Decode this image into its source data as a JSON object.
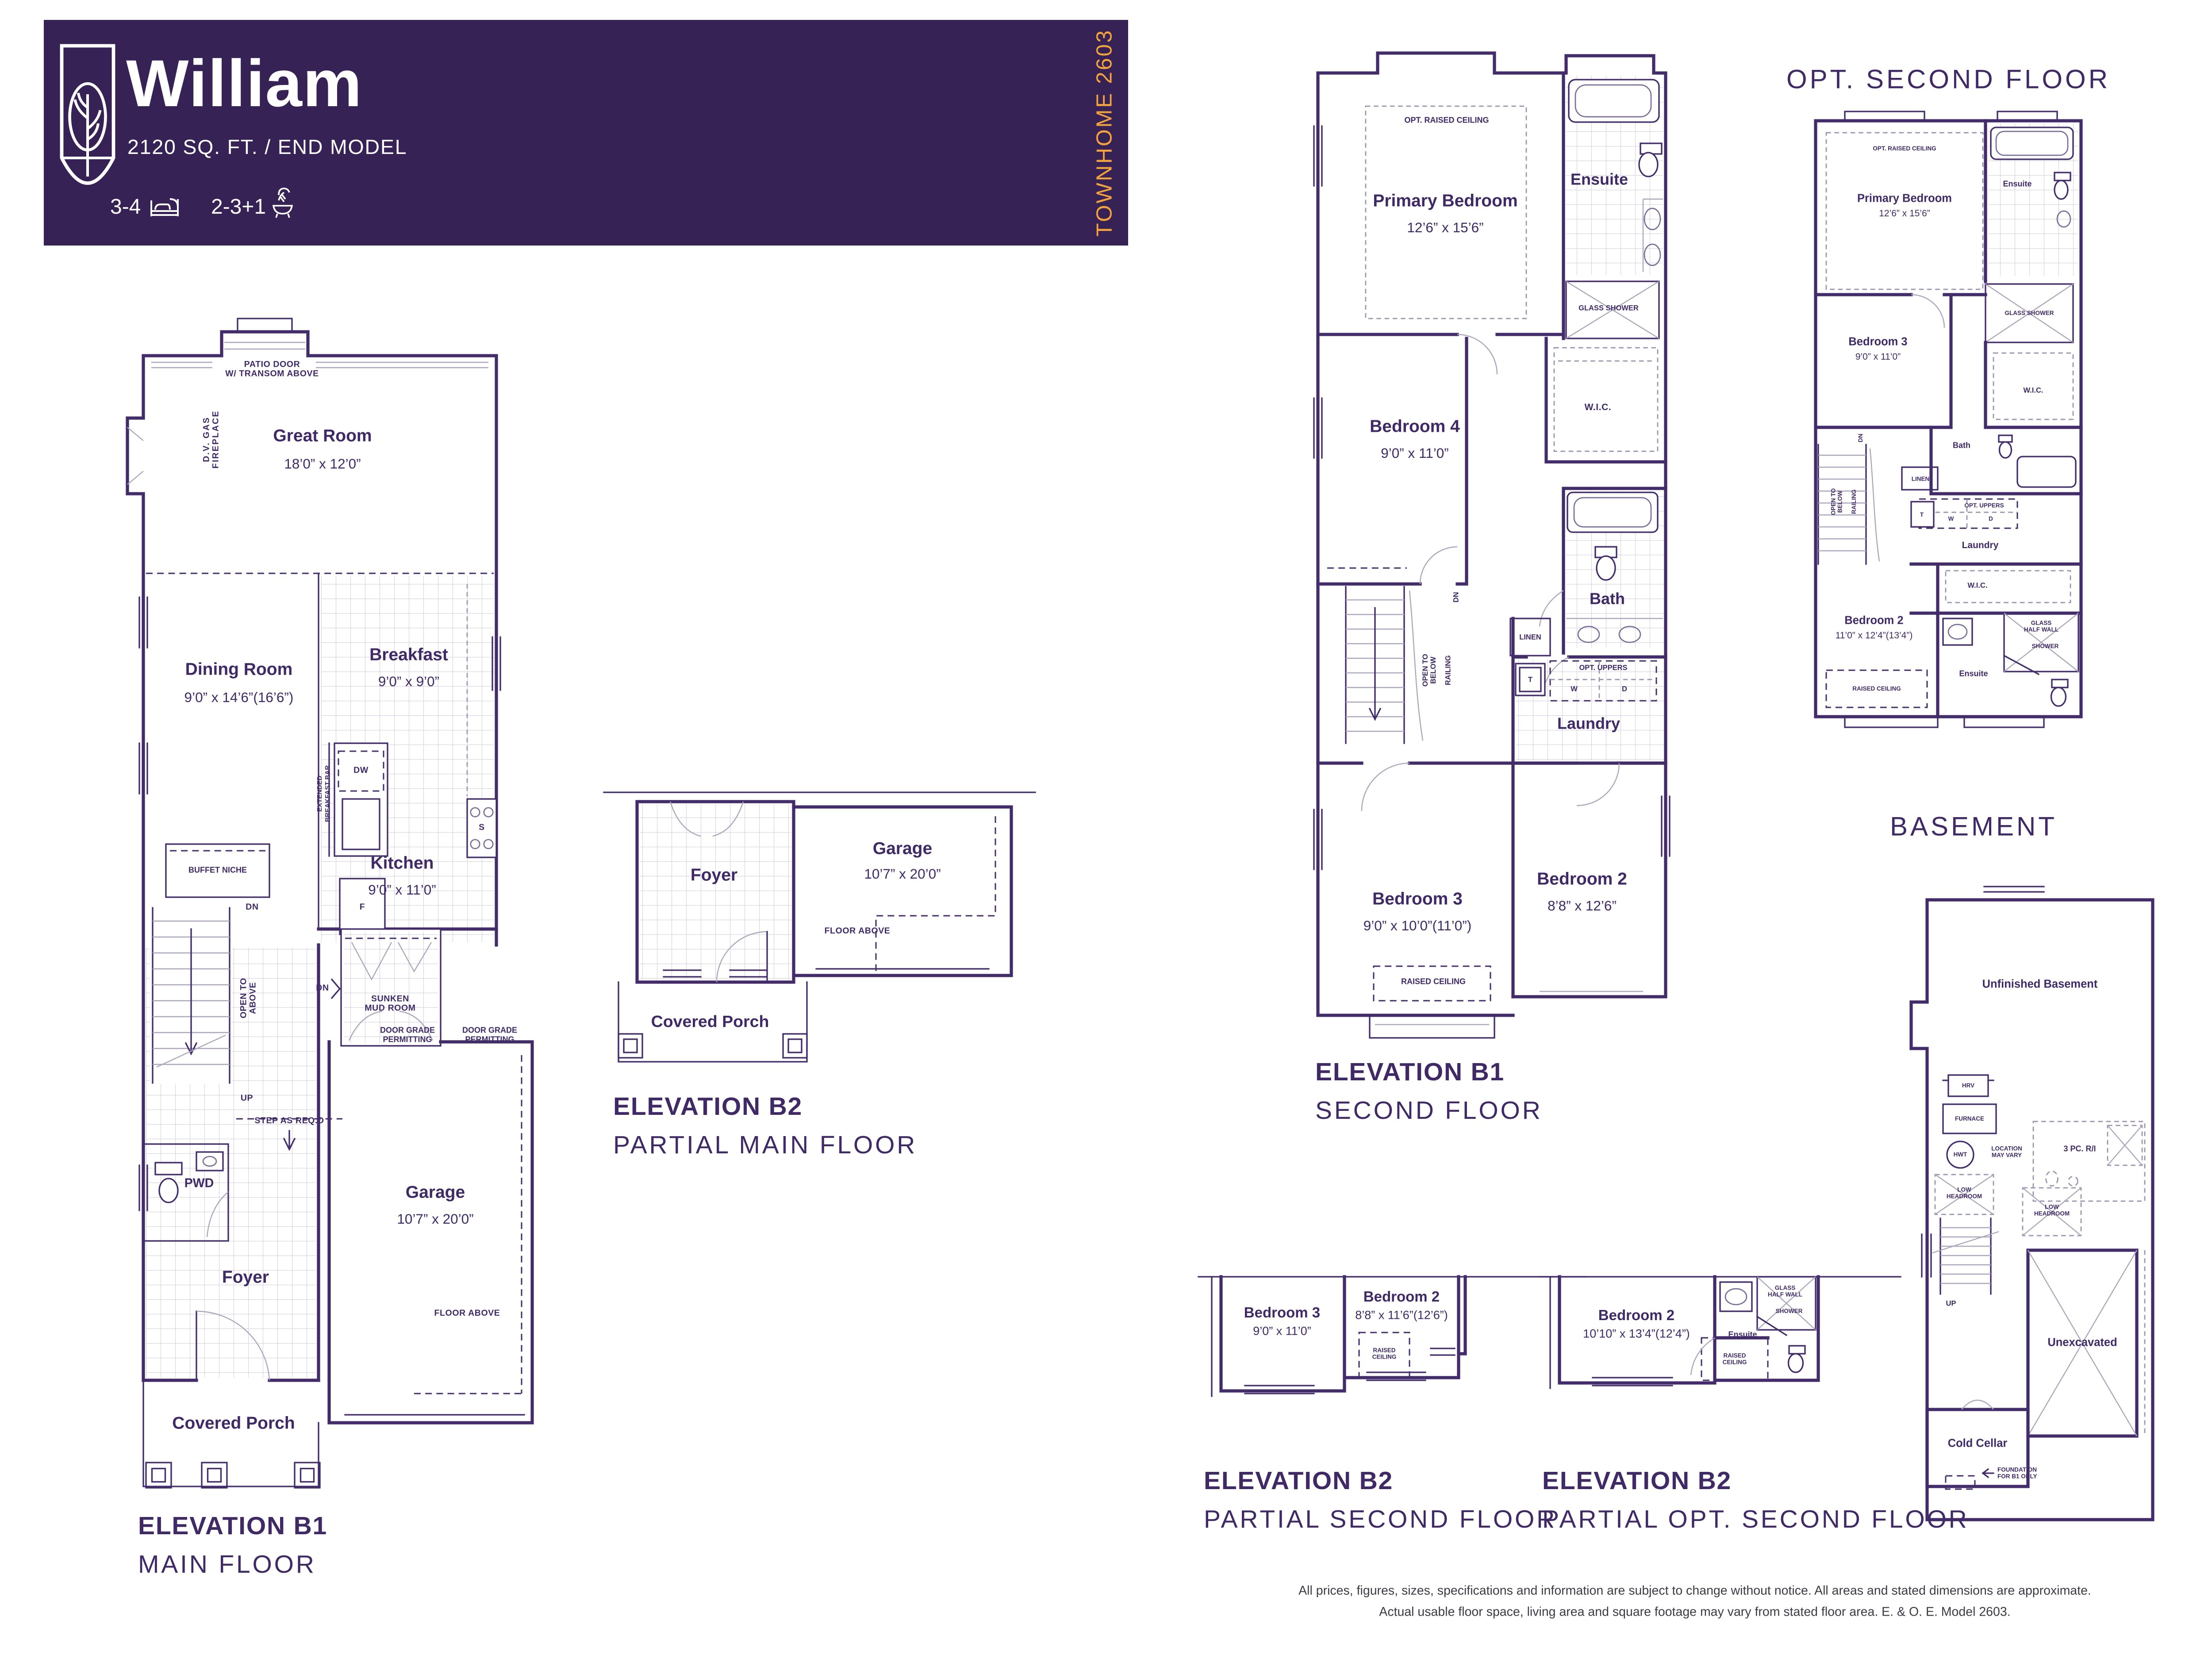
{
  "header": {
    "title": "William",
    "subtitle": "2120 SQ. FT. / END MODEL",
    "beds": "3-4",
    "baths": "2-3+1",
    "banner": "TOWNHOME 2603"
  },
  "main_floor": {
    "caption1": "ELEVATION B1",
    "caption2": "MAIN FLOOR",
    "patio1": "PATIO DOOR",
    "patio2": "W/ TRANSOM ABOVE",
    "fireplace1": "D.V. GAS",
    "fireplace2": "FIREPLACE",
    "great_room": "Great Room",
    "great_room_dims": "18’0” x 12’0”",
    "dining": "Dining Room",
    "dining_dims": "9’0” x 14’6”(16’6”)",
    "breakfast": "Breakfast",
    "breakfast_dims": "9’0” x 9’0”",
    "kitchen": "Kitchen",
    "kitchen_dims": "9’0” x 11’0”",
    "ext_bar1": "EXTENDED",
    "ext_bar2": "BREAKFAST BAR",
    "dw": "DW",
    "stove": "S",
    "fridge": "F",
    "buffet_niche": "BUFFET NICHE",
    "dn": "DN",
    "up": "UP",
    "open_above1": "OPEN TO",
    "open_above2": "ABOVE",
    "step_req": "STEP AS REQ.D",
    "sunken1": "SUNKEN",
    "sunken2": "MUD ROOM",
    "door_grade1": "DOOR GRADE",
    "door_grade2": "PERMITTING",
    "pwd": "PWD",
    "foyer": "Foyer",
    "garage": "Garage",
    "garage_dims": "10’7” x 20’0”",
    "floor_above": "FLOOR ABOVE",
    "covered_porch": "Covered Porch"
  },
  "partial_main_b2": {
    "caption1": "ELEVATION B2",
    "caption2": "PARTIAL MAIN FLOOR",
    "foyer": "Foyer",
    "garage": "Garage",
    "garage_dims": "10’7” x 20’0”",
    "floor_above": "FLOOR ABOVE",
    "covered_porch": "Covered Porch"
  },
  "second_floor": {
    "caption1": "ELEVATION B1",
    "caption2": "SECOND FLOOR",
    "opt_raised": "OPT. RAISED CEILING",
    "primary": "Primary Bedroom",
    "primary_dims": "12’6” x 15’6”",
    "ensuite": "Ensuite",
    "glass_shower": "GLASS SHOWER",
    "bedroom4": "Bedroom 4",
    "bedroom4_dims": "9’0” x 11’0”",
    "wic": "W.I.C.",
    "bath": "Bath",
    "linen": "LINEN",
    "opt_uppers": "OPT. UPPERS",
    "t": "T",
    "w": "W",
    "d": "D",
    "laundry": "Laundry",
    "open_below1": "OPEN TO",
    "open_below2": "BELOW",
    "railing": "RAILING",
    "dn": "DN",
    "bedroom3": "Bedroom 3",
    "bedroom3_dims": "9’0” x 10’0”(11’0”)",
    "bedroom2": "Bedroom 2",
    "bedroom2_dims": "8’8” x 12’6”",
    "raised_ceiling": "RAISED CEILING"
  },
  "opt_second_floor": {
    "title": "OPT. SECOND FLOOR",
    "opt_raised": "OPT. RAISED CEILING",
    "primary": "Primary Bedroom",
    "primary_dims": "12’6” x 15’6”",
    "ensuite": "Ensuite",
    "glass_shower": "GLASS SHOWER",
    "bedroom3": "Bedroom 3",
    "bedroom3_dims": "9’0” x 11’0”",
    "wic": "W.I.C.",
    "bath": "Bath",
    "linen": "LINEN",
    "opt_uppers": "OPT. UPPERS",
    "t": "T",
    "w": "W",
    "d": "D",
    "laundry": "Laundry",
    "open_below1": "OPEN TO",
    "open_below2": "BELOW",
    "railing": "RAILING",
    "dn": "DN",
    "wic2": "W.I.C.",
    "bedroom2": "Bedroom 2",
    "bedroom2_dims": "11’0” x 12’4”(13’4”)",
    "glass1": "GLASS",
    "glass2": "HALF WALL",
    "shower": "SHOWER",
    "ensuite2": "Ensuite",
    "raised_ceiling": "RAISED CEILING"
  },
  "basement": {
    "title": "BASEMENT",
    "unfinished": "Unfinished Basement",
    "hrv": "HRV",
    "furnace": "FURNACE",
    "hwt": "HWT",
    "location1": "LOCATION",
    "location2": "MAY VARY",
    "pc_ri": "3 PC. R/I",
    "low1": "LOW",
    "low2": "HEADROOM",
    "up": "UP",
    "unexcavated": "Unexcavated",
    "cold_cellar": "Cold Cellar",
    "foundation1": "FOUNDATION",
    "foundation2": "FOR B1 ONLY"
  },
  "partial_second_b2": {
    "caption1": "ELEVATION B2",
    "caption2": "PARTIAL SECOND FLOOR",
    "bedroom3": "Bedroom 3",
    "bedroom3_dims": "9’0” x 11’0”",
    "bedroom2": "Bedroom 2",
    "bedroom2_dims": "8’8” x 11’6”(12’6”)",
    "raised1": "RAISED",
    "raised2": "CEILING"
  },
  "partial_opt_b2": {
    "caption1": "ELEVATION B2",
    "caption2": "PARTIAL OPT. SECOND FLOOR",
    "bedroom2": "Bedroom 2",
    "bedroom2_dims": "10’10” x 13’4”(12’4”)",
    "ensuite": "Ensuite",
    "glass1": "GLASS",
    "glass2": "HALF WALL",
    "shower": "SHOWER",
    "raised1": "RAISED",
    "raised2": "CEILING"
  },
  "disclaimer": {
    "line1": "All prices, figures, sizes, specifications and information are subject to change without notice. All areas and stated dimensions are approximate.",
    "line2": "Actual usable floor space, living area and square footage may vary from stated floor area. E. & O. E. Model 2603."
  },
  "colors": {
    "purple": "#372255",
    "orange": "#F2A33C",
    "wall": "#432C6A",
    "light_line": "#ACA6BC"
  }
}
